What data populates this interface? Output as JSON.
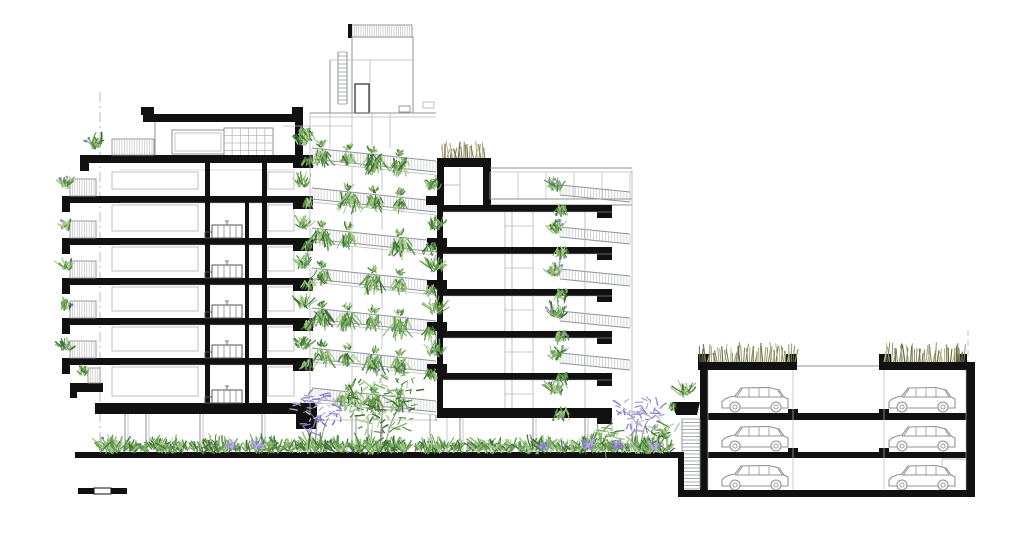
{
  "meta": {
    "kind": "architectural-cross-section-drawing",
    "canvas_w": 1024,
    "canvas_h": 541
  },
  "palette": {
    "ink": "#111111",
    "line": "#8c9094",
    "faint": "#b7babd",
    "green_dark": "#3f6e33",
    "green": "#5e974a",
    "green_light": "#82b468",
    "green_pale": "#a9cc8e",
    "purple": "#9b90d0",
    "purple_light": "#b9b0e0",
    "grass": "#8f8f62",
    "grass_light": "#aeae7e",
    "grass_dark": "#6f6f4a",
    "trunk": "#90908a",
    "car": "#8f9396",
    "white": "#ffffff"
  },
  "ground": {
    "street": {
      "x1": 75,
      "x2": 684,
      "y": 452,
      "th": 6
    },
    "step": {
      "x": 678,
      "y1": 452,
      "y2": 497,
      "th": 6
    },
    "lower": {
      "x1": 681,
      "x2": 975,
      "y": 490,
      "th": 7
    }
  },
  "scale_bar": {
    "x": 78,
    "y": 488,
    "seg_w": 16,
    "h": 6,
    "segments": [
      "dark",
      "light",
      "dark"
    ]
  },
  "left_building": {
    "roof": {
      "bar": [
        143,
        114,
        160,
        8
      ],
      "caps": [
        [
          141,
          107,
          13,
          8
        ],
        [
          292,
          107,
          11,
          8
        ]
      ]
    },
    "top_floor": {
      "left_line_x": 155,
      "window": [
        172,
        130,
        52,
        24
      ],
      "grid_window": [
        224,
        128,
        49,
        30
      ],
      "grid_cols": 6,
      "grid_rows": 4,
      "right_wall": [
        295,
        122,
        8,
        34
      ]
    },
    "terrace": {
      "slab": [
        80,
        155,
        224,
        8
      ],
      "drop": [
        80,
        155,
        9,
        16
      ],
      "railing": [
        112,
        139,
        42,
        16
      ],
      "plant": [
        96,
        146
      ]
    },
    "slab_ys": [
      196,
      238,
      278,
      318,
      358
    ],
    "slab_x1": 95,
    "slab_x2": 296,
    "slab_th": 7,
    "bottom_slab": {
      "bar": [
        95,
        403,
        222,
        11
      ],
      "end_block": [
        296,
        403,
        21,
        26
      ]
    },
    "balconies": {
      "ys": [
        196,
        238,
        278,
        318,
        358
      ],
      "slab_x": 62,
      "slab_w": 33,
      "rail_x": 70,
      "rail_w": 26,
      "rail_h": 17
    },
    "low_balcony": {
      "slab": [
        70,
        383,
        33,
        9
      ],
      "plant": [
        84,
        374
      ],
      "rail": [
        88,
        368,
        12,
        15
      ]
    },
    "core_walls": [
      [
        205,
        163,
        5,
        240
      ],
      [
        245,
        196,
        4,
        207
      ],
      [
        262,
        163,
        5,
        240
      ]
    ],
    "right_planter_ys": [
      155,
      196,
      238,
      278,
      318,
      358
    ],
    "roofside_plant": [
      306,
      130
    ],
    "stair_glyph_ys": [
      238,
      278,
      318,
      358,
      403
    ],
    "stair_glyph_x": 212,
    "floor_pairs": [
      [
        163,
        196
      ],
      [
        196,
        238
      ],
      [
        238,
        278
      ],
      [
        278,
        318
      ],
      [
        318,
        358
      ],
      [
        358,
        403
      ]
    ],
    "room_left": [
      112,
      86
    ],
    "room_right": [
      268,
      26
    ],
    "pilotis_x": [
      125,
      146,
      200,
      262
    ],
    "pilotis_y": [
      414,
      452
    ],
    "dashdot": {
      "x": 100,
      "y1": 92,
      "y2": 452
    }
  },
  "tower": {
    "roof": {
      "rail": [
        350,
        25,
        62,
        12
      ],
      "post": [
        348,
        24,
        4,
        14
      ],
      "box": [
        352,
        37,
        61,
        76
      ],
      "ladder": {
        "x1": 338,
        "x2": 347,
        "y1": 52,
        "y2": 104,
        "step": 4
      },
      "wall_x": 330,
      "door": [
        355,
        84,
        14,
        29
      ],
      "vent": [
        399,
        106,
        11,
        6
      ],
      "top_line_y": 113,
      "inner_h_y": 60,
      "inner_v_x": 370
    },
    "vent2": [
      423,
      102,
      11,
      6
    ],
    "face": {
      "left_x": 310,
      "top_y": 113,
      "verticals": [
        330,
        352,
        372,
        390
      ],
      "v_y2": 148
    },
    "rails": {
      "x1": 312,
      "x2": 436,
      "drop": 13,
      "band_h": 11,
      "levels": [
        148,
        188,
        228,
        268,
        308,
        348,
        388
      ]
    },
    "hang_x": [
      322,
      348,
      374,
      400
    ],
    "window_x": [
      352,
      382
    ],
    "ground": {
      "verticals": [
        352,
        356,
        368,
        382,
        430
      ],
      "y1": 415,
      "y2": 452,
      "storefront_y": 420,
      "x1": 317,
      "x2": 437
    }
  },
  "right_building": {
    "penthouse": {
      "grass": [
        443,
        142,
        42,
        16
      ],
      "rim": [
        437,
        158,
        53,
        9
      ],
      "lwall": [
        437,
        158,
        7,
        47
      ],
      "rwall": [
        483,
        158,
        8,
        47
      ],
      "planter": [
        426,
        196,
        17,
        9
      ],
      "plant": [
        433,
        187
      ],
      "inner_v_x": 460,
      "inner_h_y": 185
    },
    "terrace_rail": {
      "x1": 490,
      "x2": 632,
      "y": 168,
      "h": 4,
      "post_step": 28,
      "post_y2": 199
    },
    "deck": {
      "x1": 490,
      "x2": 632,
      "y1": 199,
      "y2": 205
    },
    "right_face": {
      "x": 632,
      "y1": 170,
      "y2": 452
    },
    "slab_ys": [
      205,
      247,
      289,
      331,
      373
    ],
    "slab": {
      "x1": 437,
      "x2": 612,
      "th": 7,
      "end_block_w": 15,
      "end_block_h": 13
    },
    "bottom_slab": {
      "bar": [
        437,
        408,
        175,
        10
      ],
      "end_block": [
        597,
        408,
        15,
        16
      ]
    },
    "left_planter_ys": [
      247,
      289,
      331,
      373
    ],
    "interior_x": [
      505,
      512,
      533,
      585
    ],
    "balcony_rail": {
      "x1": 560,
      "x2": 630,
      "rise": 7,
      "h": 10
    },
    "right_plant_ys": [
      205,
      247,
      289,
      331,
      373,
      408
    ],
    "right_plant_x": 556,
    "pilotis_x": [
      460,
      533,
      585
    ],
    "pilotis_y": [
      418,
      452
    ],
    "ground_glass_x": [
      447,
      612
    ]
  },
  "parking": {
    "lwall": [
      700,
      362,
      8,
      128
    ],
    "rwall": [
      966,
      362,
      9,
      135
    ],
    "roof_bars": [
      [
        698,
        362,
        99,
        8
      ],
      [
        879,
        362,
        96,
        8
      ]
    ],
    "roof_gap_line": {
      "x1": 797,
      "x2": 879,
      "y": 366
    },
    "curbs": [
      [
        698,
        354,
        12,
        9
      ],
      [
        786,
        354,
        11,
        9
      ],
      [
        879,
        354,
        12,
        9
      ],
      [
        956,
        354,
        11,
        9
      ]
    ],
    "grass": [
      [
        700,
        344,
        95,
        18
      ],
      [
        884,
        344,
        80,
        18
      ]
    ],
    "slabs": [
      [
        708,
        413,
        258,
        7
      ],
      [
        708,
        452,
        258,
        6
      ]
    ],
    "stub_x": [
      788,
      879
    ],
    "stair": {
      "x1": 682,
      "x2": 700,
      "y1": 419,
      "y2": 489,
      "step": 3.5
    },
    "planter": {
      "poly": [
        [
          672,
          402
        ],
        [
          700,
          402
        ],
        [
          697,
          415
        ],
        [
          676,
          415
        ]
      ],
      "plant": [
        686,
        394
      ]
    },
    "well_x": [
      793,
      884
    ],
    "well_y": [
      370,
      490
    ],
    "prop_line": {
      "x": 968,
      "y1": 330,
      "y2": 362
    },
    "inner_face_x": [
      708,
      966
    ],
    "inner_face_y": [
      370,
      490
    ],
    "corner_room": {
      "h": [
        942,
        459,
        966
      ],
      "v": [
        942,
        459,
        490
      ]
    },
    "car_cols": [
      721,
      888
    ],
    "car_rows": [
      386,
      425,
      464
    ],
    "car_w": 70,
    "car_h": 26
  },
  "vegetation": {
    "ground_row": {
      "x1": 106,
      "x2": 670,
      "y": 450,
      "step": 13
    },
    "purple_x": [
      232,
      258,
      544,
      588,
      618,
      655
    ],
    "trees": [
      {
        "type": "jacaranda",
        "cx": 318,
        "cy": 412,
        "r": 26,
        "base": 452
      },
      {
        "type": "green",
        "cx": 383,
        "cy": 402,
        "r": 40,
        "base": 452
      },
      {
        "type": "jacaranda",
        "cx": 638,
        "cy": 415,
        "r": 24,
        "base": 452
      },
      {
        "type": "shrub",
        "cx": 604,
        "cy": 438,
        "r": 15,
        "base": 452
      },
      {
        "type": "shrub",
        "cx": 662,
        "cy": 432,
        "r": 13,
        "base": 452
      }
    ]
  }
}
